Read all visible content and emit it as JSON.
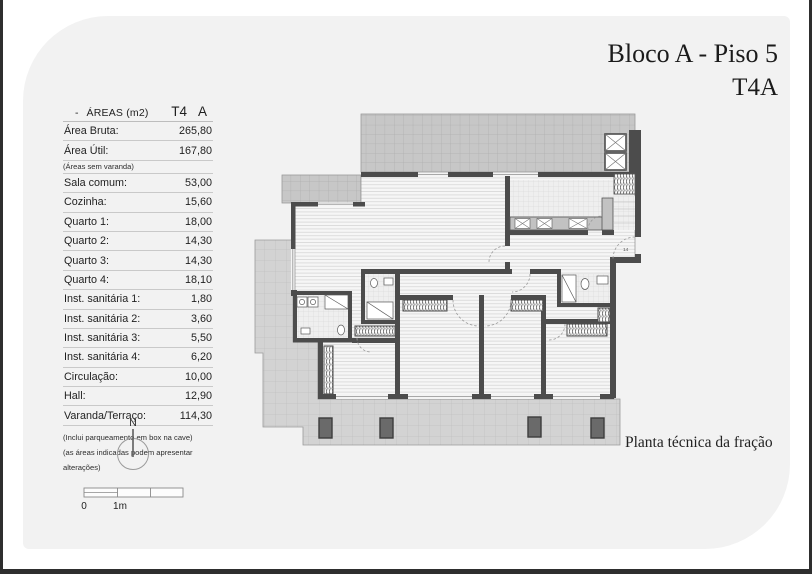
{
  "page": {
    "title_line1": "Bloco A - Piso 5",
    "title_line2": "T4A",
    "caption": "Planta técnica da fração"
  },
  "areas_table": {
    "header": {
      "dash": "-",
      "label": "ÁREAS (m2)",
      "type": "T4",
      "fraction": "A"
    },
    "rows": [
      {
        "label": "Área Bruta:",
        "value": "265,80"
      },
      {
        "label": "Área Útil:",
        "value": "167,80"
      },
      {
        "label": "(Áreas sem varanda)",
        "value": ""
      },
      {
        "label": "Sala comum:",
        "value": "53,00"
      },
      {
        "label": "Cozinha:",
        "value": "15,60"
      },
      {
        "label": "Quarto 1:",
        "value": "18,00"
      },
      {
        "label": "Quarto 2:",
        "value": "14,30"
      },
      {
        "label": "Quarto 3:",
        "value": "14,30"
      },
      {
        "label": "Quarto 4:",
        "value": "18,10"
      },
      {
        "label": "Inst. sanitária 1:",
        "value": "1,80"
      },
      {
        "label": "Inst. sanitária 2:",
        "value": "3,60"
      },
      {
        "label": "Inst. sanitária 3:",
        "value": "5,50"
      },
      {
        "label": "Inst. sanitária 4:",
        "value": "6,20"
      },
      {
        "label": "Circulação:",
        "value": "10,00"
      },
      {
        "label": "Hall:",
        "value": "12,90"
      },
      {
        "label": "Varanda/Terraço:",
        "value": "114,30"
      }
    ],
    "footnotes": [
      "(Inclui parqueamento em box na cave)",
      "(as áreas indicadas podem apresentar alterações)"
    ]
  },
  "compass": {
    "north_label": "N"
  },
  "scale_bar": {
    "zero_label": "0",
    "meter_label": "1m"
  },
  "floor_plan": {
    "door_number": "14"
  },
  "colors": {
    "card_background": "#f2f2f2",
    "wall": "#4c4c4c",
    "terrace_grid": "#c7c7c7",
    "terrace_grid_light": "#d3d3d3",
    "interior_floor": "#f6f6f6",
    "page_border": "#2e2e2e"
  }
}
